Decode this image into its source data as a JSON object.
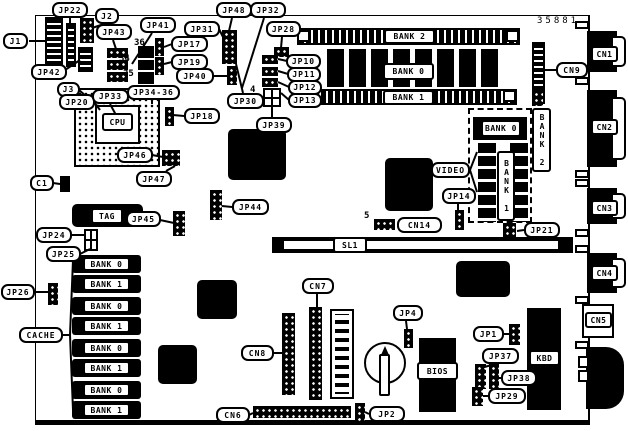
{
  "diagram": {
    "part_number": "35881",
    "ink_color": "#000000",
    "paper_color": "#ffffff"
  },
  "labels": [
    [
      "j1",
      "J1",
      3,
      33,
      25,
      16
    ],
    [
      "jp22",
      "JP22",
      52,
      2,
      36,
      16
    ],
    [
      "j2",
      "J2",
      95,
      8,
      24,
      16
    ],
    [
      "jp42",
      "JP42",
      31,
      64,
      36,
      16
    ],
    [
      "j3",
      "J3",
      57,
      82,
      23,
      15
    ],
    [
      "jp20",
      "JP20",
      59,
      94,
      36,
      16
    ],
    [
      "jp33",
      "JP33",
      92,
      89,
      37,
      15
    ],
    [
      "jp34-36",
      "JP34-36",
      127,
      85,
      53,
      15
    ],
    [
      "jp43",
      "JP43",
      96,
      24,
      36,
      16
    ],
    [
      "jp41",
      "JP41",
      140,
      17,
      36,
      16
    ],
    [
      "jp17",
      "JP17",
      171,
      36,
      37,
      16
    ],
    [
      "jp19",
      "JP19",
      171,
      54,
      37,
      16
    ],
    [
      "jp40",
      "JP40",
      176,
      68,
      38,
      16
    ],
    [
      "jp31",
      "JP31",
      184,
      21,
      36,
      16
    ],
    [
      "jp48",
      "JP48",
      216,
      2,
      36,
      16
    ],
    [
      "jp32",
      "JP32",
      250,
      2,
      36,
      16
    ],
    [
      "jp28",
      "JP28",
      266,
      21,
      35,
      16
    ],
    [
      "jp30",
      "JP30",
      227,
      93,
      37,
      16
    ],
    [
      "jp10",
      "JP10",
      286,
      54,
      35,
      15
    ],
    [
      "jp11",
      "JP11",
      287,
      67,
      34,
      15
    ],
    [
      "jp12",
      "JP12",
      288,
      80,
      34,
      15
    ],
    [
      "jp13",
      "JP13",
      288,
      93,
      34,
      15
    ],
    [
      "jp39",
      "JP39",
      256,
      117,
      36,
      16
    ],
    [
      "jp18",
      "JP18",
      184,
      108,
      36,
      16
    ],
    [
      "jp46",
      "JP46",
      117,
      147,
      36,
      16
    ],
    [
      "jp47",
      "JP47",
      136,
      171,
      36,
      16
    ],
    [
      "c1",
      "C1",
      30,
      175,
      24,
      16
    ],
    [
      "cn9",
      "CN9",
      556,
      62,
      32,
      16
    ],
    [
      "video",
      "VIDEO",
      431,
      162,
      39,
      16
    ],
    [
      "jp14",
      "JP14",
      442,
      188,
      34,
      16
    ],
    [
      "jp21",
      "JP21",
      524,
      222,
      36,
      16
    ],
    [
      "cn14",
      "CN14",
      397,
      217,
      45,
      16
    ],
    [
      "jp45",
      "JP45",
      126,
      211,
      35,
      16
    ],
    [
      "jp44",
      "JP44",
      232,
      199,
      37,
      16
    ],
    [
      "jp24",
      "JP24",
      36,
      227,
      36,
      16
    ],
    [
      "jp25",
      "JP25",
      46,
      246,
      35,
      16
    ],
    [
      "jp26",
      "JP26",
      1,
      284,
      34,
      16
    ],
    [
      "cache",
      "CACHE",
      19,
      327,
      44,
      16
    ],
    [
      "cn7",
      "CN7",
      302,
      278,
      32,
      16
    ],
    [
      "cn8",
      "CN8",
      241,
      345,
      33,
      16
    ],
    [
      "cn6",
      "CN6",
      216,
      407,
      34,
      16
    ],
    [
      "jp2",
      "JP2",
      369,
      406,
      36,
      16
    ],
    [
      "jp4",
      "JP4",
      393,
      305,
      30,
      16
    ],
    [
      "jp1",
      "JP1",
      473,
      326,
      31,
      16
    ],
    [
      "jp37",
      "JP37",
      482,
      348,
      37,
      16
    ],
    [
      "jp38",
      "JP38",
      501,
      370,
      36,
      16
    ],
    [
      "jp29",
      "JP29",
      488,
      388,
      38,
      16
    ]
  ],
  "component_boxes": [
    [
      "bank2-dimm-label",
      "BANK 2",
      384,
      29,
      51,
      15,
      false
    ],
    [
      "bank0-dram-label",
      "BANK 0",
      383,
      63,
      51,
      17,
      false
    ],
    [
      "bank1-dimm-label",
      "BANK 1",
      383,
      90,
      51,
      15,
      false
    ],
    [
      "video-bank0-label",
      "BANK 0",
      481,
      120,
      40,
      17,
      false
    ],
    [
      "video-bank1-label",
      "BANK 1",
      497,
      151,
      18,
      70,
      true
    ],
    [
      "video-bank2-label",
      "BANK 2",
      532,
      108,
      19,
      64,
      true
    ],
    [
      "cpu-label",
      "CPU",
      102,
      113,
      31,
      18,
      false
    ],
    [
      "tag-label",
      "TAG",
      91,
      208,
      32,
      16,
      false
    ],
    [
      "sl1-label",
      "SL1",
      333,
      237,
      34,
      16,
      false
    ],
    [
      "bios-label",
      "BIOS",
      417,
      362,
      41,
      18,
      false
    ],
    [
      "kbd-label",
      "KBD",
      529,
      350,
      31,
      16,
      false
    ],
    [
      "cn1-label",
      "CN1",
      591,
      46,
      27,
      16,
      false
    ],
    [
      "cn2-label",
      "CN2",
      591,
      119,
      27,
      16,
      false
    ],
    [
      "cn3-label",
      "CN3",
      591,
      200,
      27,
      16,
      false
    ],
    [
      "cn4-label",
      "CN4",
      591,
      265,
      27,
      16,
      false
    ],
    [
      "cn5-label",
      "CN5",
      585,
      312,
      27,
      16,
      false
    ],
    [
      "cache-bank-label-1",
      "BANK 0",
      83,
      257,
      47,
      14,
      false
    ],
    [
      "cache-bank-label-2",
      "BANK 1",
      83,
      277,
      47,
      14,
      false
    ],
    [
      "cache-bank-label-3",
      "BANK 0",
      83,
      299,
      47,
      14,
      false
    ],
    [
      "cache-bank-label-4",
      "BANK 1",
      83,
      319,
      47,
      14,
      false
    ],
    [
      "cache-bank-label-5",
      "BANK 0",
      83,
      341,
      47,
      14,
      false
    ],
    [
      "cache-bank-label-6",
      "BANK 1",
      83,
      361,
      47,
      14,
      false
    ],
    [
      "cache-bank-label-7",
      "BANK 0",
      83,
      383,
      47,
      14,
      false
    ],
    [
      "cache-bank-label-8",
      "BANK 1",
      83,
      403,
      47,
      14,
      false
    ]
  ],
  "pin_markers": [
    [
      "pin-36",
      "36",
      134,
      38
    ],
    [
      "pin-34",
      "34",
      119,
      54
    ],
    [
      "pin-35",
      "35",
      123,
      69
    ],
    [
      "pin-4",
      "4",
      250,
      85
    ],
    [
      "pin-5",
      "5",
      364,
      211
    ]
  ],
  "shapes": [
    [
      "j1-connector",
      "ladv",
      45,
      17,
      18,
      55
    ],
    [
      "jp22-connector",
      "ladv",
      66,
      23,
      10,
      44
    ],
    [
      "j2-connector",
      "dots",
      80,
      18,
      14,
      25
    ],
    [
      "jp42-connector",
      "ladv",
      78,
      47,
      15,
      25
    ],
    [
      "cpu-socket",
      "pga",
      74,
      88,
      86,
      79
    ],
    [
      "cpu-socket-center",
      "white",
      95,
      105,
      45,
      39
    ],
    [
      "jp43-jumper-1",
      "dots",
      107,
      48,
      21,
      10
    ],
    [
      "jp43-jumper-2",
      "dots",
      107,
      60,
      21,
      10
    ],
    [
      "jp43-jumper-3",
      "dots",
      107,
      72,
      21,
      10
    ],
    [
      "pin36-block",
      "black",
      138,
      46,
      16,
      12
    ],
    [
      "pin34-block",
      "black",
      138,
      60,
      16,
      10
    ],
    [
      "pin35-block",
      "black",
      138,
      72,
      16,
      12
    ],
    [
      "jp17-jumper",
      "dots",
      155,
      38,
      9,
      18
    ],
    [
      "jp19-jumper",
      "dots",
      155,
      57,
      9,
      18
    ],
    [
      "jp48-jumper-column",
      "dots",
      222,
      30,
      15,
      34
    ],
    [
      "jp40-jumper",
      "dots",
      227,
      66,
      10,
      19
    ],
    [
      "jp28-jumper",
      "dots",
      274,
      47,
      15,
      10
    ],
    [
      "jp10-jumper",
      "dots",
      262,
      55,
      16,
      9
    ],
    [
      "jp11-jumper",
      "dots",
      262,
      67,
      16,
      9
    ],
    [
      "jp12-jumper",
      "dots",
      262,
      78,
      16,
      9
    ],
    [
      "jp39-jumper-block",
      "grid",
      263,
      88,
      18,
      19
    ],
    [
      "jp18-jumper",
      "dots",
      165,
      107,
      9,
      19
    ],
    [
      "chipset-chip",
      "chip",
      228,
      129,
      58,
      51
    ],
    [
      "jp46-jumper",
      "dots",
      162,
      150,
      18,
      16
    ],
    [
      "c1-capacitor",
      "black",
      60,
      176,
      10,
      16
    ],
    [
      "bank2-dimm-slot",
      "ladh",
      297,
      28,
      223,
      17
    ],
    [
      "simm-latch-1",
      "white",
      297,
      30,
      13,
      12
    ],
    [
      "simm-latch-2",
      "white",
      506,
      30,
      13,
      12
    ],
    [
      "bank0-dram-row",
      "chiprow",
      327,
      49,
      173,
      38
    ],
    [
      "bank1-dimm-slot",
      "ladh",
      298,
      89,
      219,
      16
    ],
    [
      "simm-latch-3",
      "white",
      298,
      90,
      13,
      12
    ],
    [
      "simm-latch-4",
      "white",
      503,
      90,
      13,
      12
    ],
    [
      "cn9-connector",
      "ladv",
      532,
      42,
      13,
      62
    ],
    [
      "cn1-port",
      "black",
      587,
      31,
      30,
      41
    ],
    [
      "cn1-shell",
      "dshell",
      613,
      36,
      13,
      31
    ],
    [
      "cn2-port",
      "black",
      587,
      90,
      30,
      77
    ],
    [
      "cn2-shell",
      "dshell",
      613,
      97,
      13,
      63
    ],
    [
      "cn3-port",
      "black",
      587,
      188,
      30,
      36
    ],
    [
      "cn3-shell",
      "dshell",
      613,
      193,
      13,
      26
    ],
    [
      "cn4-port",
      "black",
      587,
      253,
      30,
      40
    ],
    [
      "cn4-shell",
      "dshell",
      613,
      258,
      13,
      30
    ],
    [
      "cn5-box",
      "white",
      582,
      304,
      32,
      34
    ],
    [
      "kbd-din-port",
      "din",
      586,
      347,
      38,
      62
    ],
    [
      "kbd-din-nub-1",
      "white",
      578,
      356,
      11,
      12
    ],
    [
      "kbd-din-nub-2",
      "white",
      578,
      370,
      11,
      12
    ],
    [
      "video-chip",
      "chip",
      385,
      158,
      48,
      53
    ],
    [
      "video-memory-frame",
      "dashed",
      468,
      108,
      64,
      115
    ],
    [
      "video-bank0-chip",
      "black",
      473,
      117,
      54,
      23
    ],
    [
      "video-memory-column-1",
      "ladvt",
      478,
      143,
      18,
      79
    ],
    [
      "video-memory-column-2",
      "ladvt",
      510,
      143,
      18,
      79
    ],
    [
      "bank2-header-grid",
      "dots",
      532,
      90,
      11,
      16
    ],
    [
      "jp21-jumper",
      "dots",
      503,
      223,
      13,
      16
    ],
    [
      "sl1-slot-bar",
      "black",
      272,
      237,
      301,
      16
    ],
    [
      "sl1-slot-opening",
      "whiteplain",
      284,
      241,
      274,
      8
    ],
    [
      "cn14-header",
      "dots",
      374,
      219,
      21,
      11
    ],
    [
      "jp14-jumper",
      "dots",
      455,
      210,
      9,
      20
    ],
    [
      "tag-chip",
      "chip",
      72,
      204,
      71,
      23
    ],
    [
      "jp45-jumper",
      "dots",
      173,
      211,
      12,
      25
    ],
    [
      "jp44-jumper",
      "dots",
      210,
      190,
      12,
      30
    ],
    [
      "jp24-jumper",
      "grid",
      84,
      229,
      14,
      22
    ],
    [
      "jp26-jumper",
      "dots",
      48,
      283,
      10,
      22
    ],
    [
      "cache-chip-1",
      "cchip",
      72,
      255,
      69,
      18
    ],
    [
      "cache-chip-2",
      "cchip",
      72,
      275,
      69,
      18
    ],
    [
      "cache-chip-3",
      "cchip",
      72,
      297,
      69,
      18
    ],
    [
      "cache-chip-4",
      "cchip",
      72,
      317,
      69,
      18
    ],
    [
      "cache-chip-5",
      "cchip",
      72,
      339,
      69,
      18
    ],
    [
      "cache-chip-6",
      "cchip",
      72,
      359,
      69,
      18
    ],
    [
      "cache-chip-7",
      "cchip",
      72,
      381,
      69,
      18
    ],
    [
      "cache-chip-8",
      "cchip",
      72,
      401,
      69,
      18
    ],
    [
      "chip-u1",
      "chip",
      197,
      280,
      40,
      39
    ],
    [
      "chip-u2",
      "chip",
      158,
      345,
      39,
      39
    ],
    [
      "chip-u3",
      "chip",
      456,
      261,
      54,
      36
    ],
    [
      "cn7-header",
      "dots",
      309,
      307,
      13,
      93
    ],
    [
      "cn8-header",
      "dots",
      282,
      313,
      13,
      82
    ],
    [
      "slot-connector",
      "slotb",
      330,
      309,
      24,
      90
    ],
    [
      "cn6-header",
      "dots",
      253,
      406,
      98,
      12
    ],
    [
      "jp2-jumper",
      "dots",
      355,
      403,
      10,
      18
    ],
    [
      "battery-holder",
      "circ",
      364,
      342,
      42,
      42
    ],
    [
      "battery-tip",
      "tri",
      381,
      346,
      8,
      9
    ],
    [
      "battery-body",
      "penbody",
      379,
      354,
      11,
      42
    ],
    [
      "jp4-jumper",
      "dots",
      404,
      329,
      9,
      19
    ],
    [
      "bios-chip",
      "black",
      419,
      338,
      37,
      74
    ],
    [
      "jp1-jumper",
      "dots",
      509,
      324,
      11,
      21
    ],
    [
      "jp37-jumper",
      "dots",
      475,
      364,
      11,
      25
    ],
    [
      "jp38-jumper",
      "dots",
      489,
      364,
      10,
      25
    ],
    [
      "jp29-jumper",
      "dots",
      472,
      387,
      11,
      19
    ],
    [
      "kbd-controller-chip",
      "black",
      527,
      308,
      34,
      102
    ],
    [
      "edge-stub-1",
      "white",
      575,
      21,
      14,
      8
    ],
    [
      "edge-stub-2",
      "white",
      575,
      77,
      14,
      8
    ],
    [
      "edge-stub-3",
      "white",
      575,
      170,
      14,
      8
    ],
    [
      "edge-stub-4",
      "white",
      575,
      179,
      14,
      8
    ],
    [
      "edge-stub-5",
      "white",
      575,
      229,
      14,
      8
    ],
    [
      "edge-stub-6",
      "white",
      575,
      245,
      14,
      8
    ],
    [
      "edge-stub-7",
      "white",
      575,
      296,
      14,
      8
    ],
    [
      "edge-stub-8",
      "white",
      575,
      341,
      14,
      8
    ]
  ],
  "leader_lines": [
    [
      29,
      41,
      46,
      41
    ],
    [
      70,
      18,
      70,
      24
    ],
    [
      104,
      24,
      92,
      28
    ],
    [
      62,
      72,
      80,
      60
    ],
    [
      79,
      90,
      86,
      96
    ],
    [
      94,
      102,
      100,
      110
    ],
    [
      110,
      104,
      116,
      115
    ],
    [
      113,
      40,
      116,
      49
    ],
    [
      152,
      33,
      132,
      64
    ],
    [
      172,
      44,
      164,
      47
    ],
    [
      172,
      62,
      164,
      64
    ],
    [
      213,
      76,
      227,
      76
    ],
    [
      219,
      29,
      223,
      37
    ],
    [
      232,
      18,
      229,
      31
    ],
    [
      264,
      18,
      242,
      88
    ],
    [
      282,
      37,
      281,
      48
    ],
    [
      243,
      93,
      236,
      64
    ],
    [
      287,
      61,
      278,
      59
    ],
    [
      288,
      74,
      278,
      71
    ],
    [
      289,
      87,
      278,
      82
    ],
    [
      289,
      100,
      281,
      93
    ],
    [
      272,
      117,
      272,
      106
    ],
    [
      184,
      116,
      173,
      115
    ],
    [
      152,
      155,
      163,
      157
    ],
    [
      166,
      171,
      175,
      166
    ],
    [
      53,
      183,
      60,
      184
    ],
    [
      556,
      70,
      545,
      70
    ],
    [
      470,
      170,
      477,
      152
    ],
    [
      470,
      170,
      477,
      192
    ],
    [
      458,
      204,
      458,
      211
    ],
    [
      524,
      230,
      517,
      231
    ],
    [
      160,
      220,
      174,
      223
    ],
    [
      232,
      207,
      222,
      206
    ],
    [
      71,
      235,
      84,
      235
    ],
    [
      80,
      254,
      90,
      249
    ],
    [
      34,
      292,
      48,
      292
    ],
    [
      62,
      335,
      70,
      335
    ],
    [
      70,
      335,
      73,
      260
    ],
    [
      70,
      335,
      73,
      410
    ],
    [
      317,
      294,
      317,
      307
    ],
    [
      273,
      353,
      282,
      353
    ],
    [
      249,
      415,
      253,
      413
    ],
    [
      369,
      414,
      365,
      412
    ],
    [
      406,
      321,
      407,
      329
    ],
    [
      504,
      334,
      509,
      334
    ],
    [
      495,
      364,
      481,
      368
    ],
    [
      501,
      378,
      490,
      378
    ],
    [
      488,
      396,
      483,
      396
    ],
    [
      152,
      100,
      152,
      104
    ]
  ]
}
